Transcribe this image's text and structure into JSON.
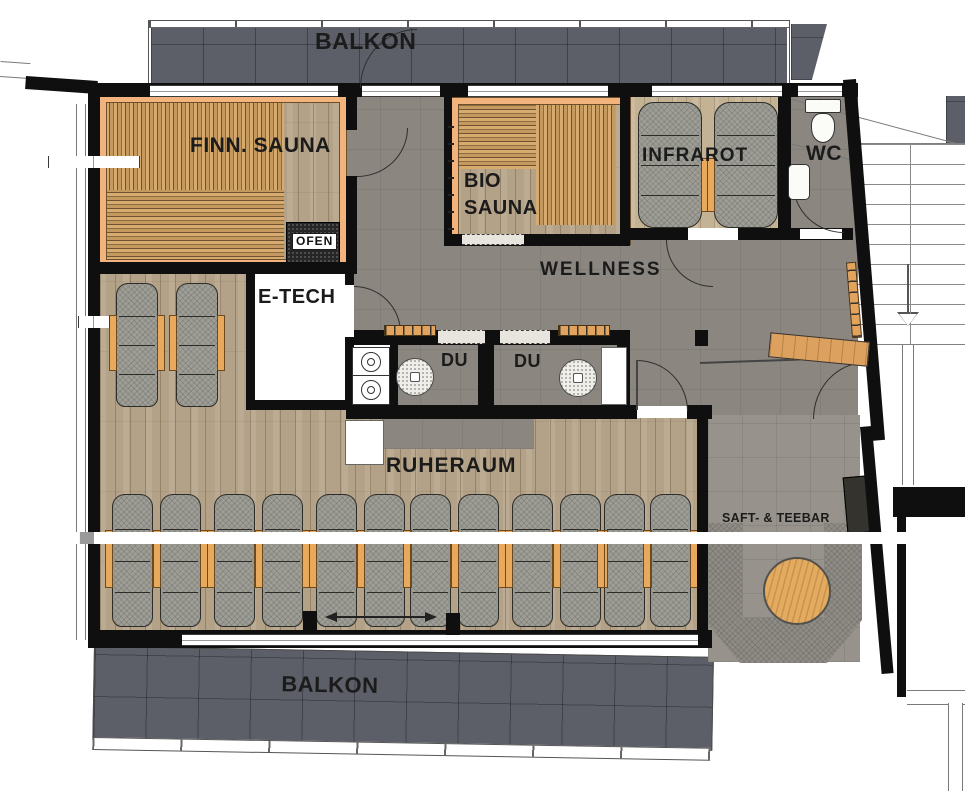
{
  "plan": {
    "title_labels": {
      "balcony_top": "BALKON",
      "balcony_bottom": "BALKON"
    },
    "rooms": {
      "finn_sauna": "FINN. SAUNA",
      "ofen": "OFEN",
      "bio_sauna": "BIO SAUNA",
      "infrarot": "INFRAROT",
      "wc": "WC",
      "wellness": "WELLNESS",
      "etech": "E-TECH",
      "du_left": "DU",
      "du_right": "DU",
      "ruheraum": "RUHERAUM",
      "saft_teebar": "SAFT- & TEEBAR"
    },
    "furniture": {
      "ruheraum_lounger_pairs": 6,
      "upper_loungers": 2,
      "infrarot_loungers": 2,
      "shower_drains": 2,
      "round_table": 1
    },
    "colors": {
      "wall": "#0f0f0f",
      "balcony_tile": "#5d5f68",
      "floor_tile": "#8b8680",
      "teebar_tile": "#97938c",
      "wood_floor": "#b3a287",
      "infrared_wood": "#c4b294",
      "bench_stripe_light": "#d7aa6d",
      "bench_stripe_dark": "#6e5233",
      "sauna_frame": "#f2b37d",
      "lounger_grey": "#9e9e96",
      "side_table_orange": "#e9a95c",
      "round_table_wood": "#e3ab60"
    }
  }
}
